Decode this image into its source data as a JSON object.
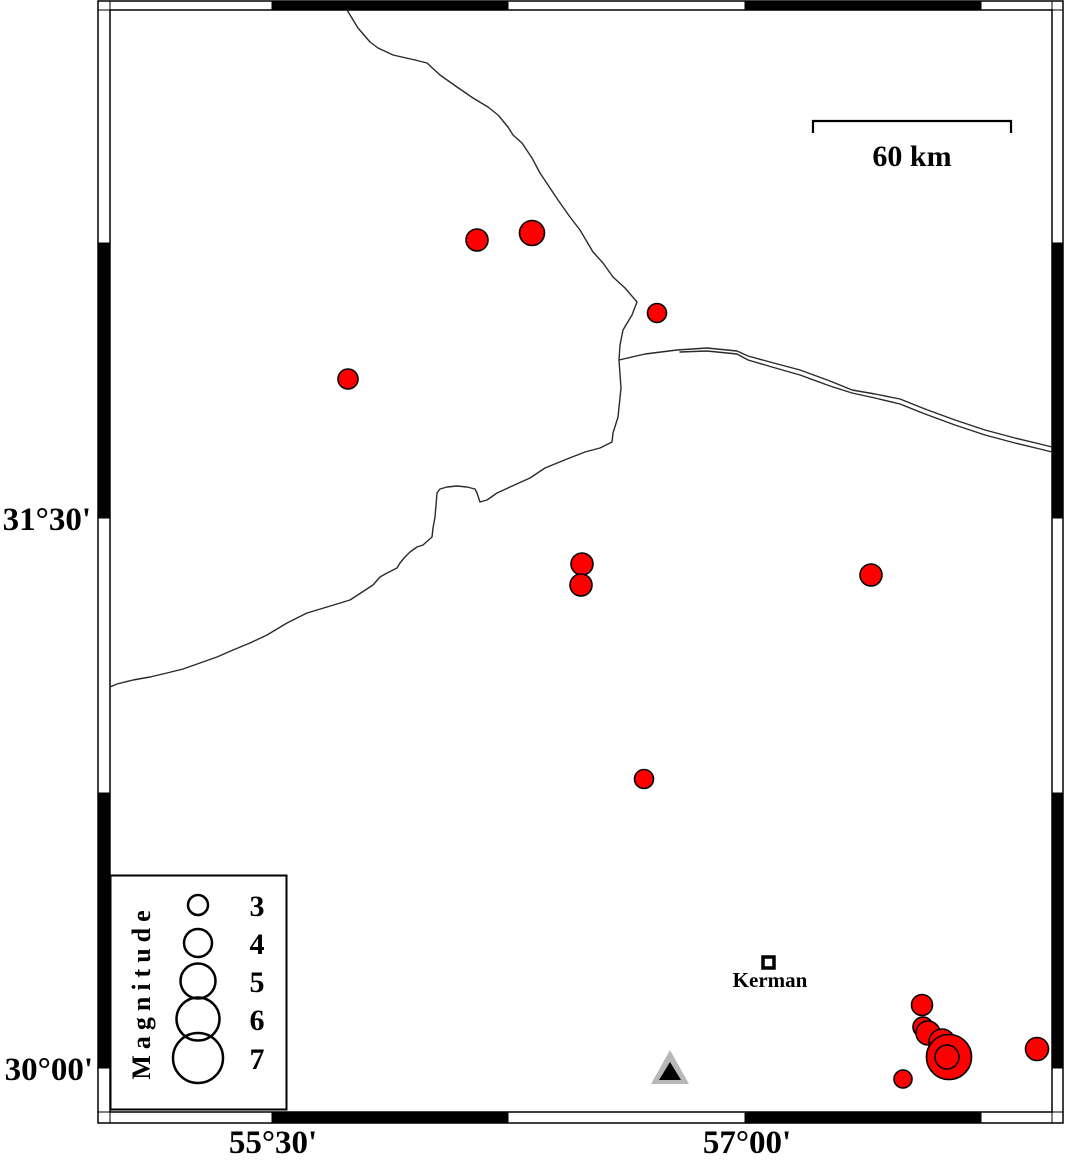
{
  "map": {
    "axes": {
      "left": [
        {
          "label": "31°30'",
          "y": 518
        },
        {
          "label": "30°00'",
          "y": 1068
        }
      ],
      "bottom": [
        {
          "label": "55°30'",
          "x": 273
        },
        {
          "label": "57°00'",
          "x": 747
        }
      ]
    },
    "frame": {
      "outer": {
        "x": 98,
        "y": 1,
        "w": 965,
        "h": 1122
      },
      "inner": {
        "x": 110,
        "y": 10,
        "w": 942,
        "h": 1102
      },
      "x_ticks": [
        272,
        508,
        745,
        981
      ],
      "y_ticks": [
        243,
        518,
        793,
        1068
      ]
    },
    "scale_bar": {
      "label": "60 km",
      "x1": 813,
      "x2": 1011,
      "y": 121,
      "tick_drop": 12
    },
    "legend": {
      "title": "Magnitude",
      "box": {
        "x": 110.5,
        "y": 875.5,
        "w": 176,
        "h": 234
      },
      "circle_cx": 198,
      "label_x": 257,
      "entries": [
        {
          "magnitude": "3",
          "cy": 905,
          "r": 10
        },
        {
          "magnitude": "4",
          "cy": 943,
          "r": 14
        },
        {
          "magnitude": "5",
          "cy": 981,
          "r": 17.5
        },
        {
          "magnitude": "6",
          "cy": 1019,
          "r": 21.5
        },
        {
          "magnitude": "7",
          "cy": 1058,
          "r": 25
        }
      ]
    },
    "city": {
      "name": "Kerman",
      "x": 768.5,
      "y": 962.5,
      "square_size": 11
    },
    "station": {
      "outer": [
        [
          670,
          1050
        ],
        [
          651,
          1084
        ],
        [
          689,
          1084
        ]
      ],
      "inner": [
        [
          670,
          1062
        ],
        [
          659,
          1080
        ],
        [
          681,
          1080
        ]
      ],
      "outer_color": "#b8b8b8",
      "inner_color": "#000000"
    },
    "earthquakes": [
      {
        "x": 477,
        "y": 240,
        "r": 11
      },
      {
        "x": 532,
        "y": 233,
        "r": 12.5
      },
      {
        "x": 657,
        "y": 313,
        "r": 9.5
      },
      {
        "x": 348,
        "y": 379,
        "r": 10
      },
      {
        "x": 582,
        "y": 564,
        "r": 11
      },
      {
        "x": 581,
        "y": 585,
        "r": 11
      },
      {
        "x": 871,
        "y": 575,
        "r": 11
      },
      {
        "x": 644,
        "y": 779,
        "r": 9.5
      },
      {
        "x": 903,
        "y": 1079,
        "r": 9
      },
      {
        "x": 922,
        "y": 1005,
        "r": 10.5
      },
      {
        "x": 923,
        "y": 1027,
        "r": 10
      },
      {
        "x": 928,
        "y": 1033,
        "r": 12
      },
      {
        "x": 942,
        "y": 1042,
        "r": 13
      },
      {
        "x": 949,
        "y": 1057,
        "r": 22.5
      },
      {
        "x": 947,
        "y": 1057,
        "r": 12
      },
      {
        "x": 1037,
        "y": 1049,
        "r": 11.5
      }
    ],
    "fault_lines": [
      {
        "name": "north-river-line",
        "points": [
          [
            347,
            10
          ],
          [
            358,
            28
          ],
          [
            370,
            42
          ],
          [
            378,
            48
          ],
          [
            393,
            55
          ],
          [
            415,
            60
          ],
          [
            427,
            63
          ],
          [
            440,
            75
          ],
          [
            457,
            87
          ],
          [
            473,
            98
          ],
          [
            488,
            107
          ],
          [
            498,
            115
          ],
          [
            508,
            127
          ],
          [
            513,
            135
          ],
          [
            522,
            143
          ],
          [
            532,
            158
          ],
          [
            540,
            173
          ],
          [
            548,
            185
          ],
          [
            558,
            200
          ],
          [
            570,
            217
          ],
          [
            580,
            230
          ],
          [
            593,
            252
          ],
          [
            603,
            263
          ],
          [
            613,
            277
          ],
          [
            625,
            288
          ],
          [
            637,
            302
          ],
          [
            632,
            315
          ],
          [
            623,
            330
          ],
          [
            620,
            345
          ],
          [
            619,
            360
          ]
        ]
      },
      {
        "name": "east-line-a",
        "points": [
          [
            619,
            360
          ],
          [
            645,
            354
          ],
          [
            677,
            350
          ],
          [
            707,
            348
          ],
          [
            737,
            351
          ],
          [
            748,
            356
          ],
          [
            770,
            362
          ],
          [
            800,
            370
          ],
          [
            830,
            381
          ],
          [
            852,
            390
          ],
          [
            875,
            394
          ],
          [
            900,
            399
          ],
          [
            925,
            409
          ],
          [
            955,
            420
          ],
          [
            985,
            430
          ],
          [
            1015,
            438
          ],
          [
            1040,
            444
          ],
          [
            1052,
            447
          ]
        ]
      },
      {
        "name": "east-line-b",
        "points": [
          [
            680,
            352
          ],
          [
            707,
            351
          ],
          [
            737,
            354
          ],
          [
            748,
            360
          ],
          [
            772,
            367
          ],
          [
            800,
            375
          ],
          [
            830,
            386
          ],
          [
            852,
            393
          ],
          [
            875,
            398
          ],
          [
            900,
            404
          ],
          [
            925,
            414
          ],
          [
            955,
            425
          ],
          [
            985,
            435
          ],
          [
            1015,
            443
          ],
          [
            1040,
            449
          ],
          [
            1052,
            452
          ]
        ]
      },
      {
        "name": "southwest-line",
        "points": [
          [
            619,
            360
          ],
          [
            621,
            388
          ],
          [
            618,
            417
          ],
          [
            613,
            433
          ],
          [
            612,
            442
          ],
          [
            600,
            448
          ],
          [
            585,
            452
          ],
          [
            567,
            459
          ],
          [
            545,
            468
          ],
          [
            530,
            478
          ],
          [
            510,
            487
          ],
          [
            497,
            493
          ],
          [
            487,
            500
          ],
          [
            480,
            502
          ],
          [
            477,
            493
          ],
          [
            475,
            489
          ],
          [
            467,
            487
          ],
          [
            457,
            486
          ],
          [
            447,
            487
          ],
          [
            440,
            489
          ],
          [
            437,
            493
          ],
          [
            436,
            505
          ],
          [
            435,
            517
          ],
          [
            433,
            528
          ],
          [
            432,
            537
          ],
          [
            423,
            545
          ],
          [
            417,
            547
          ],
          [
            410,
            552
          ],
          [
            405,
            557
          ],
          [
            400,
            563
          ],
          [
            397,
            568
          ],
          [
            387,
            573
          ],
          [
            380,
            577
          ],
          [
            373,
            585
          ],
          [
            350,
            600
          ],
          [
            327,
            607
          ],
          [
            307,
            613
          ],
          [
            287,
            623
          ],
          [
            267,
            635
          ],
          [
            250,
            643
          ],
          [
            233,
            650
          ],
          [
            217,
            657
          ],
          [
            200,
            663
          ],
          [
            183,
            669
          ],
          [
            167,
            673
          ],
          [
            150,
            677
          ],
          [
            133,
            680
          ],
          [
            117,
            684
          ],
          [
            110,
            687
          ]
        ]
      }
    ],
    "colors": {
      "epicenter_fill": "#ff0000",
      "epicenter_stroke": "#000000",
      "line": "#2a2a2a",
      "frame_black": "#000000",
      "frame_white": "#ffffff"
    }
  }
}
